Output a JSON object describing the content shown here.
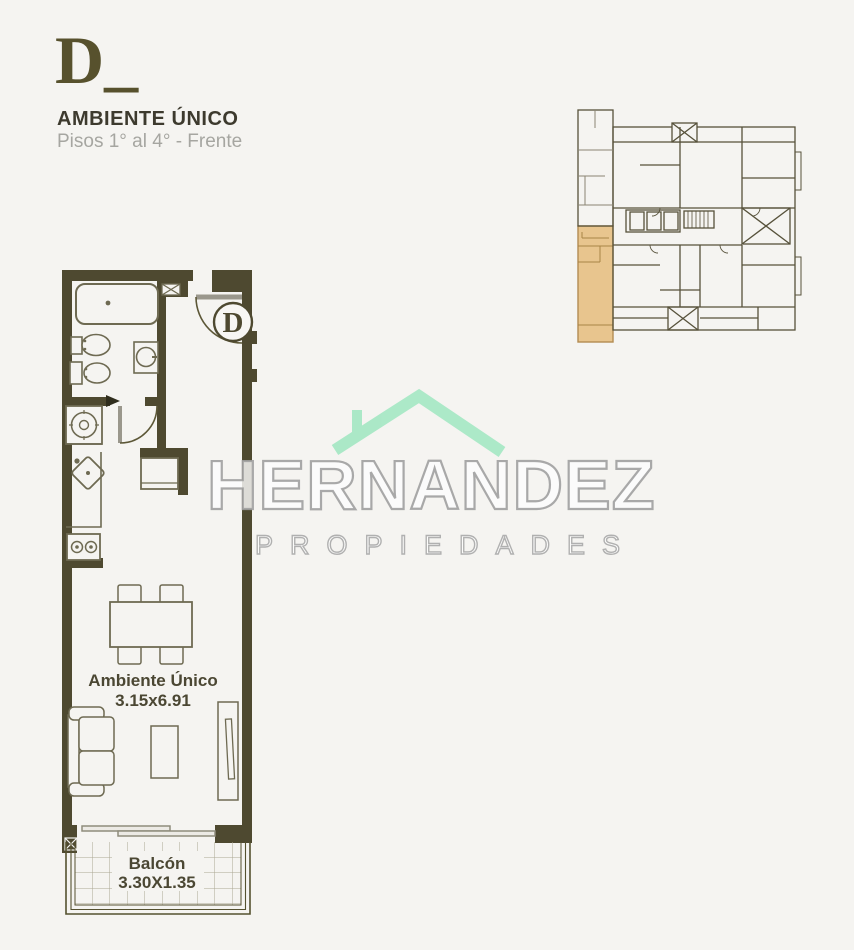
{
  "header": {
    "plan_letter": "D_",
    "title": "AMBIENTE ÚNICO",
    "subtitle": "Pisos 1° al 4° - Frente"
  },
  "floor_plan": {
    "badge": "D",
    "room_name": "Ambiente Único",
    "room_size": "3.15x6.91",
    "balcony_name": "Balcón",
    "balcony_size": "3.30X1.35",
    "wall_color": "#4e4930",
    "fixture_line_color": "#6e6a52",
    "fixtures": [
      "bathtub",
      "bidet",
      "toilet",
      "washbasin",
      "washing-machine",
      "kitchen-sink",
      "stove",
      "fridge",
      "dining-table",
      "dining-chairs",
      "sofa",
      "coffee-table",
      "tv-unit",
      "entry-door",
      "bathroom-door",
      "sliding-door",
      "balcony-tiles"
    ]
  },
  "key_plan": {
    "line_color": "#57523b",
    "light_line_color": "#8a8574",
    "highlight_color": "#e8c58e",
    "highlight_border": "#b38c52"
  },
  "watermark": {
    "brand": "HERNANDEZ",
    "tagline": "PROPIEDADES",
    "roof_color": "#a5e7c4"
  }
}
